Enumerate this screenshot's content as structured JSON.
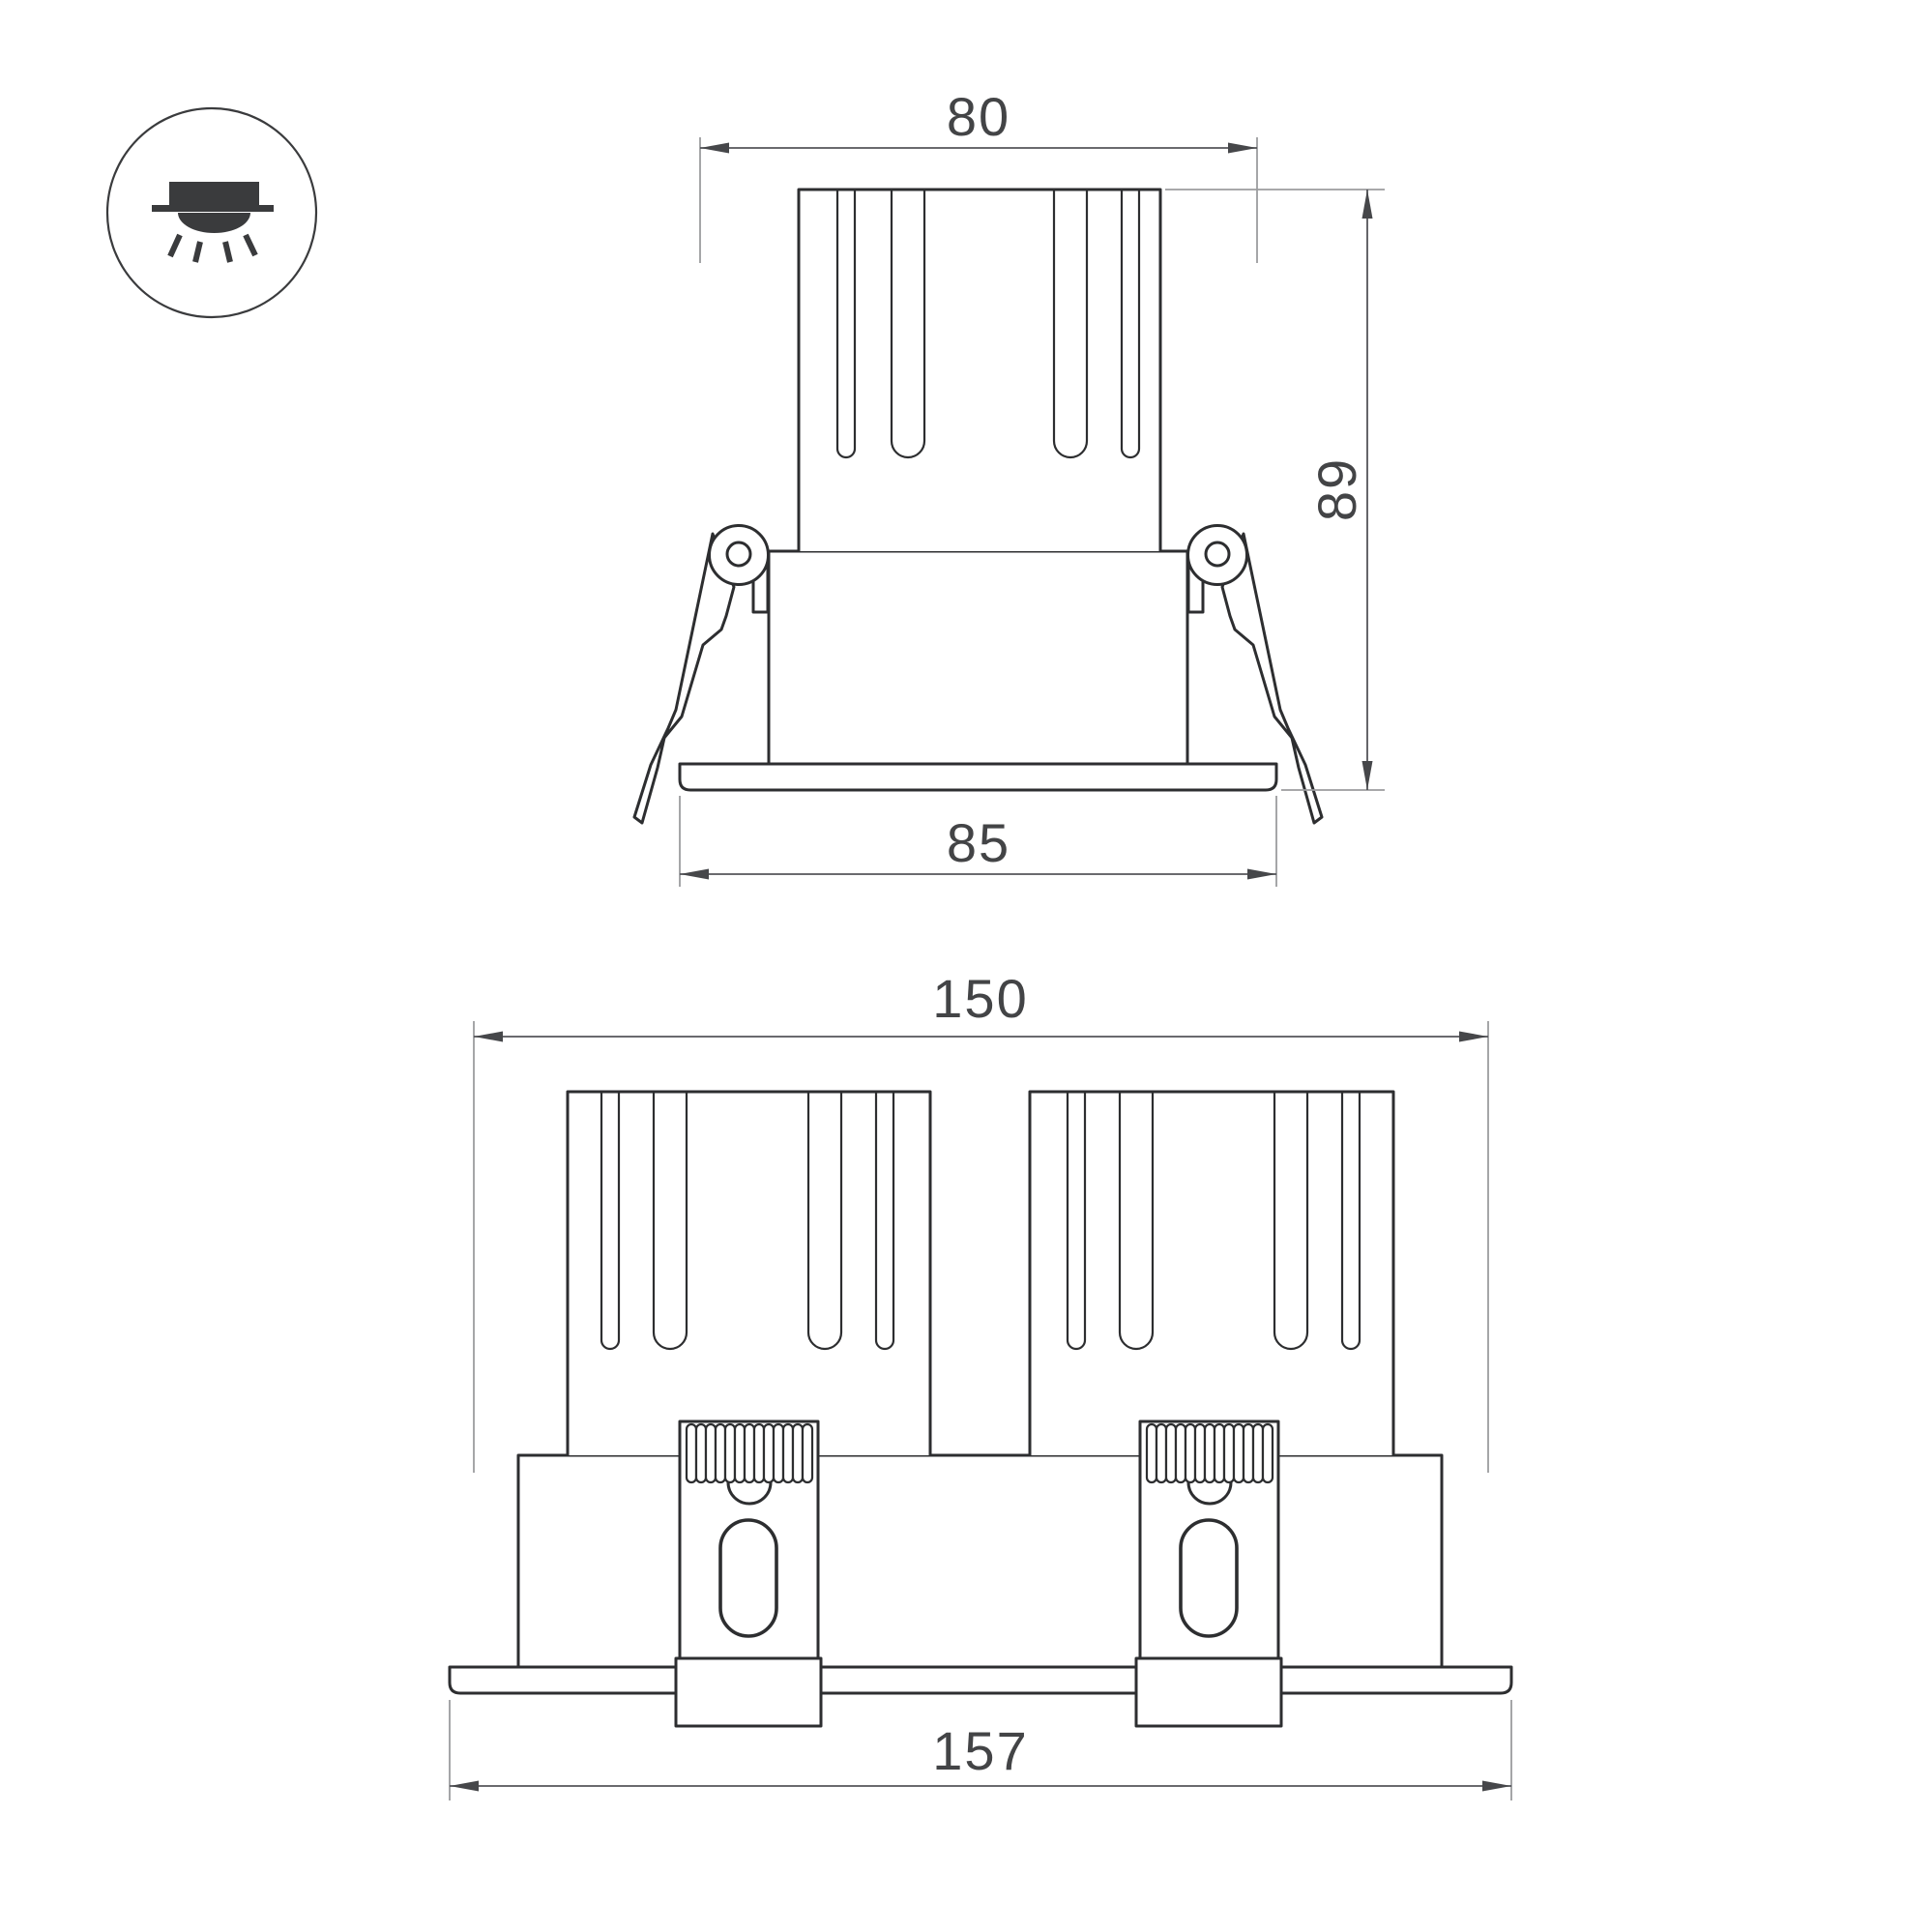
{
  "drawing": {
    "background": "#ffffff",
    "colors": {
      "object_line": "#2d2e30",
      "dimension_line": "#54555a",
      "extension_line": "#9b9c9e",
      "label_text": "#434446",
      "icon": "#3a3b3d"
    },
    "icon": {
      "name": "recessed-downlight-icon"
    },
    "views": {
      "single": {
        "name": "front-view-single-luminaire",
        "dimensions": {
          "top_width": "80",
          "height": "89",
          "flange_width": "85"
        }
      },
      "double": {
        "name": "front-view-double-luminaire",
        "dimensions": {
          "body_width": "150",
          "flange_width": "157"
        }
      }
    }
  }
}
